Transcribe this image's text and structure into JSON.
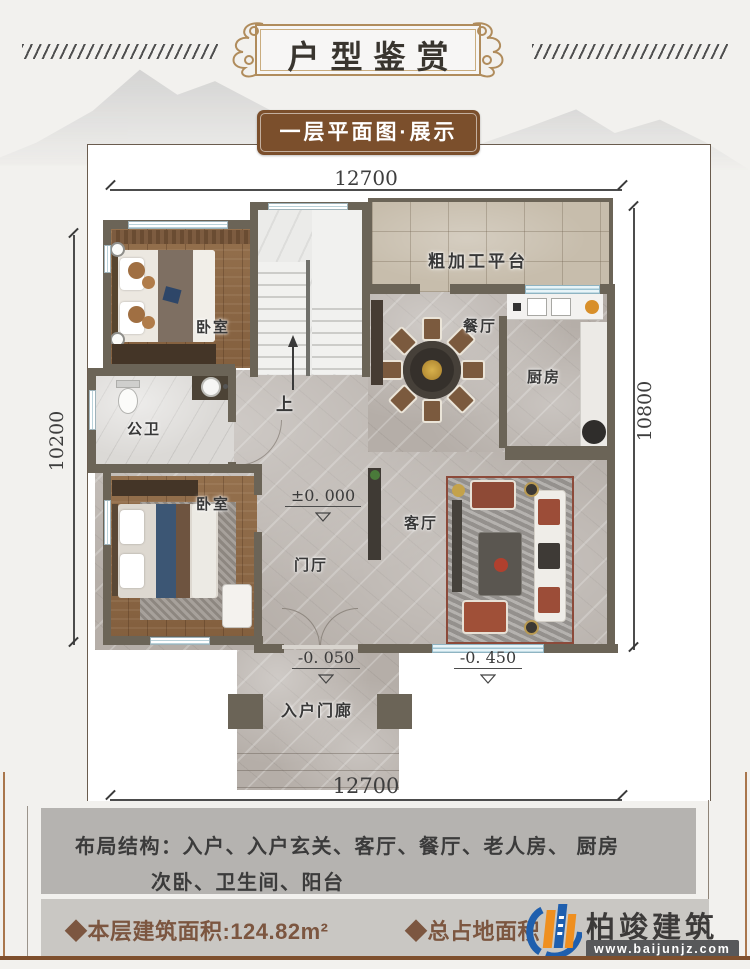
{
  "header": {
    "title": "户型鉴赏"
  },
  "subtitle": {
    "label": "一层平面图·展示"
  },
  "plan": {
    "dims": {
      "top": "12700",
      "bottom": "12700",
      "left": "10200",
      "right": "10800"
    },
    "rooms": {
      "bedroom_top": "卧室",
      "platform": "粗加工平台",
      "dining": "餐厅",
      "kitchen": "厨房",
      "bathroom": "公卫",
      "bedroom_bottom": "卧室",
      "foyer": "门厅",
      "living": "客厅",
      "porch": "入户门廊",
      "stair_up": "上"
    },
    "elevations": {
      "foyer": "±0. 000",
      "porch": "-0. 050",
      "living": "-0. 450"
    }
  },
  "layout_box": {
    "label": "布局结构：",
    "line1": "入户、入户玄关、客厅、餐厅、老人房、 厨房",
    "line2": "次卧、卫生间、阳台"
  },
  "footer": {
    "floor_area": "◆本层建筑面积:124.82m²",
    "site_area": "◆总占地面积",
    "brand": "柏竣建筑",
    "website": "www.baijunjz.com"
  },
  "colors": {
    "accent_brown": "#7b4f2c",
    "wall": "#6b6457",
    "logo_blue": "#1f5fae",
    "logo_orange": "#ef8f1f"
  }
}
